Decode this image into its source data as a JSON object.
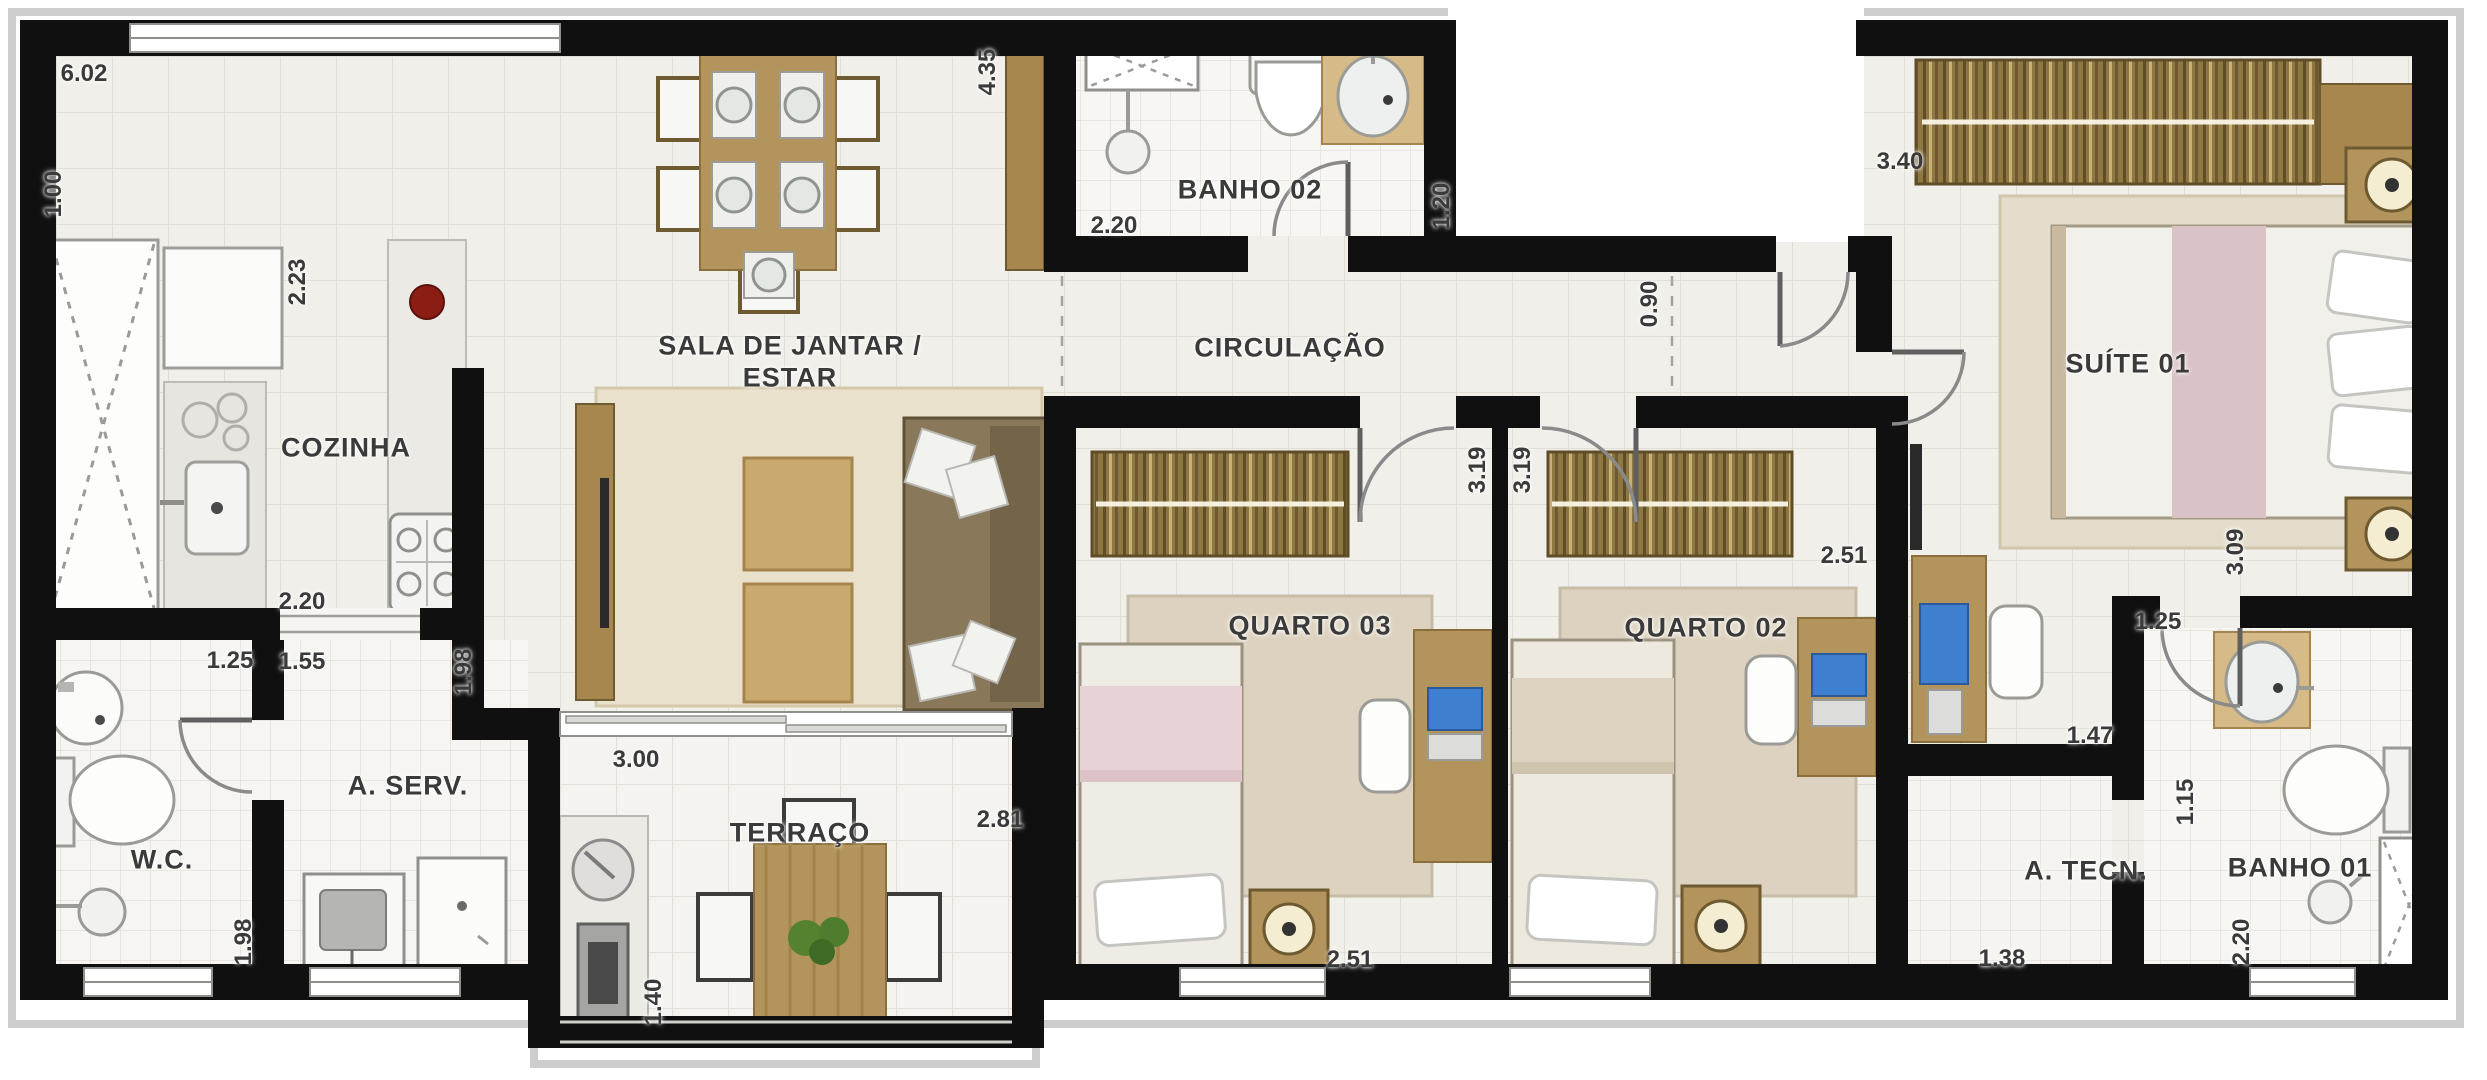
{
  "plan": {
    "type": "apartment-floor-plan",
    "rooms": [
      {
        "id": "cozinha",
        "label": "COZINHA"
      },
      {
        "id": "sala",
        "label": "SALA DE JANTAR /",
        "label2": "ESTAR"
      },
      {
        "id": "circulacao",
        "label": "CIRCULAÇÃO"
      },
      {
        "id": "banho02",
        "label": "BANHO 02"
      },
      {
        "id": "suite01",
        "label": "SUÍTE 01"
      },
      {
        "id": "quarto03",
        "label": "QUARTO 03"
      },
      {
        "id": "quarto02",
        "label": "QUARTO 02"
      },
      {
        "id": "wc",
        "label": "W.C."
      },
      {
        "id": "aserv",
        "label": "A. SERV."
      },
      {
        "id": "terraco",
        "label": "TERRAÇO"
      },
      {
        "id": "atecn",
        "label": "A. TECN."
      },
      {
        "id": "banho01",
        "label": "BANHO 01"
      }
    ],
    "dimensions": [
      {
        "id": "top-width",
        "value": "6.02"
      },
      {
        "id": "left-recess",
        "value": "1.00"
      },
      {
        "id": "kitchen-depth",
        "value": "2.23"
      },
      {
        "id": "dining-depth",
        "value": "4.35"
      },
      {
        "id": "banho02-width",
        "value": "2.20"
      },
      {
        "id": "banho02-depth",
        "value": "1.20"
      },
      {
        "id": "entry-door",
        "value": "0.90"
      },
      {
        "id": "suite-width",
        "value": "3.40"
      },
      {
        "id": "quarto03-depth",
        "value": "3.19"
      },
      {
        "id": "quarto02-depth",
        "value": "3.19"
      },
      {
        "id": "quarto02-width",
        "value": "2.51"
      },
      {
        "id": "suite-depth",
        "value": "3.09"
      },
      {
        "id": "cozinha-width",
        "value": "2.20"
      },
      {
        "id": "wc-width",
        "value": "1.25"
      },
      {
        "id": "aserv-width",
        "value": "1.55"
      },
      {
        "id": "kitchen-pass",
        "value": "1.98"
      },
      {
        "id": "sala-width",
        "value": "3.00"
      },
      {
        "id": "terraco-width",
        "value": "2.81"
      },
      {
        "id": "terraco-depth",
        "value": "1.40"
      },
      {
        "id": "wc-depth",
        "value": "1.98"
      },
      {
        "id": "quarto03-width",
        "value": "2.51"
      },
      {
        "id": "atecn-width",
        "value": "1.38"
      },
      {
        "id": "atecn-depth",
        "value": "1.15"
      },
      {
        "id": "suite-nook-width",
        "value": "1.47"
      },
      {
        "id": "banho01-width",
        "value": "1.25"
      },
      {
        "id": "banho01-depth",
        "value": "2.20"
      }
    ],
    "colors": {
      "wall": "#101010",
      "floor": "#f1efe9",
      "tile_line": "#dcd8ce",
      "bath_floor": "#f7f6f3",
      "wood": "#b3945c",
      "wood_dark": "#8f7742",
      "rug_sala": "#eae1cd",
      "rug_bedroom": "#ddd2bf",
      "bed_pink": "#e7d3d6",
      "bed_cream": "#ddd3c0",
      "counter_tan": "#d6ba88",
      "screen_blue": "#3f7fd0",
      "sofa": "#8a785a",
      "plant": "#55822f",
      "accent_red": "#8c1d14"
    }
  }
}
